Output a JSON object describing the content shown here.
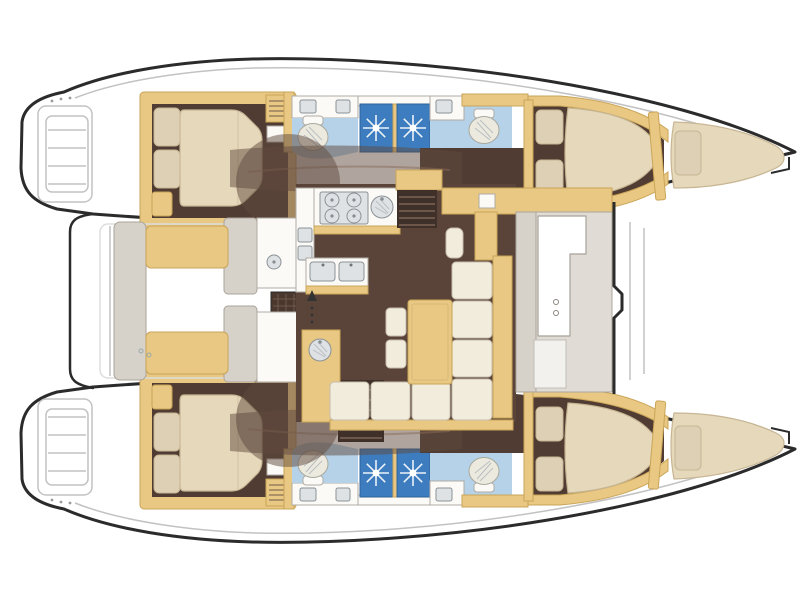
{
  "figure": {
    "type": "floor-plan",
    "subject": "catamaran yacht accommodation and deck plan, top view",
    "orientation": "bows to the right, transom steps to the left",
    "text_visible": "none"
  },
  "palette": {
    "outline": "#2b2b2b",
    "deck_line": "#c2c2c2",
    "exterior_grey": "#e0dcd5",
    "exterior_grey_dark": "#d6d1c9",
    "exterior_stroke": "#aaa49b",
    "tan": "#e9c883",
    "tan_stroke": "#c9a558",
    "cream": "#f2ecdc",
    "cream_stroke": "#c6bcab",
    "mattress": "#e6d8bb",
    "mattress_stroke": "#c7b694",
    "pillow": "#ded0b4",
    "cabin_floor": "#503c33",
    "saloon_floor": "#5a443a",
    "stair": "#40302a",
    "stair_tread": "#6d564a",
    "wash": "rgba(96,74,62,0.5)",
    "wash_streak": "#8a6c58",
    "bath_floor": "#b5d2e8",
    "shower": "#3c7cbf",
    "shower_stroke": "#2f639a",
    "white_fix": "#fbfaf7",
    "fix_stroke": "#b0aca4",
    "steel": "#dfe2e4",
    "steel_stroke": "#8b9196",
    "porcelain": "#eceadf",
    "porcelain_stroke": "#a9a99e",
    "hatch_dark": "#4a382f",
    "hatch_line": "#6e584a",
    "arrow": "#333333"
  },
  "rooms": [
    {
      "name": "aft-cabin",
      "side": "starboard",
      "features": [
        "island-double-bed",
        "two-pillows",
        "louver-locker",
        "seat"
      ]
    },
    {
      "name": "aft-cabin",
      "side": "port",
      "features": [
        "island-double-bed",
        "two-pillows",
        "louver-locker",
        "seat"
      ]
    },
    {
      "name": "aft-head",
      "side": "starboard",
      "features": [
        "toilet",
        "vanity-sink",
        "shower-stall"
      ]
    },
    {
      "name": "forward-head",
      "side": "starboard",
      "features": [
        "toilet",
        "vanity-sink",
        "shower-stall"
      ]
    },
    {
      "name": "aft-head",
      "side": "port",
      "features": [
        "toilet",
        "vanity-sink",
        "shower-stall"
      ]
    },
    {
      "name": "forward-head",
      "side": "port",
      "features": [
        "toilet",
        "vanity-sink",
        "shower-stall"
      ]
    },
    {
      "name": "forward-cabin",
      "side": "starboard",
      "features": [
        "double-bed",
        "two-pillows"
      ]
    },
    {
      "name": "forward-cabin",
      "side": "port",
      "features": [
        "double-bed",
        "two-pillows"
      ]
    },
    {
      "name": "forepeak-berth",
      "side": "starboard",
      "features": [
        "single-berth",
        "pillow"
      ]
    },
    {
      "name": "forepeak-berth",
      "side": "port",
      "features": [
        "single-berth",
        "pillow"
      ]
    },
    {
      "name": "saloon",
      "features": [
        "galley-4-burner-stove",
        "round-sink",
        "double-sink",
        "wet-bar-sink",
        "l-shaped-sofa",
        "table",
        "nav-seat",
        "stairs-to-starboard-hull",
        "stairs-to-port-hull",
        "entry-arrow"
      ]
    },
    {
      "name": "forward-settee",
      "features": [
        "grey-cushions",
        "white-l-table",
        "two-cup-recesses"
      ]
    },
    {
      "name": "aft-cockpit",
      "features": [
        "double-bench-seat",
        "wet-bar-module",
        "grill-hatch"
      ]
    },
    {
      "name": "transom-steps",
      "side": "both"
    },
    {
      "name": "foredeck",
      "features": []
    }
  ]
}
